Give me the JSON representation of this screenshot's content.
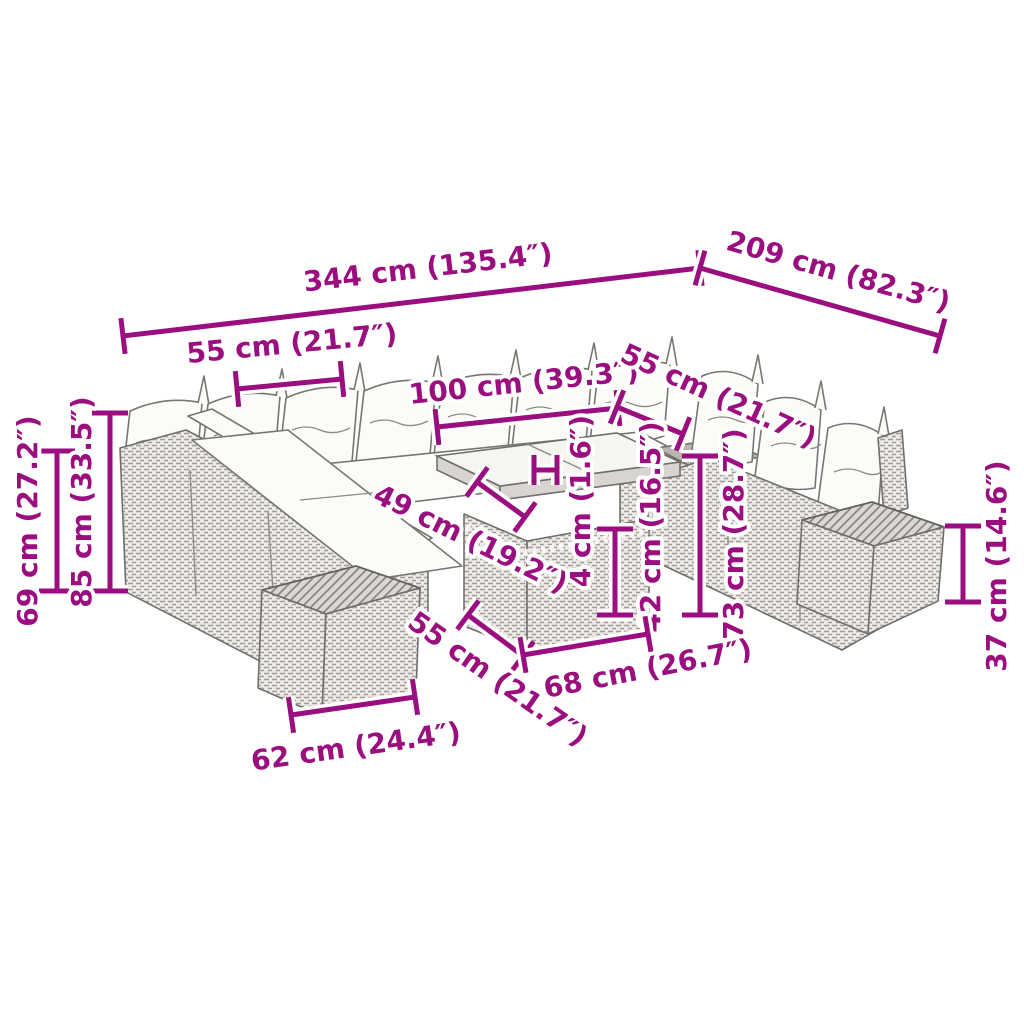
{
  "diagram_title": "garden-lounge-set-dimension-diagram",
  "colors": {
    "dimension_accent": "#9A0E7F",
    "outline": "#6F6F6F",
    "cushion": "#FBFBF8",
    "rattan_base": "#ECEAE6",
    "rattan_weave": "#A29D96",
    "background": "#FFFFFF"
  },
  "dimensions": [
    {
      "id": "total-width",
      "label": "344 cm (135.4″)",
      "line": {
        "x1": 123,
        "y1": 336,
        "x2": 700,
        "y2": 268
      },
      "label_pos": {
        "x": 428,
        "y": 269,
        "rotate": -6.7
      }
    },
    {
      "id": "total-depth",
      "label": "209 cm (82.3″)",
      "line": {
        "x1": 700,
        "y1": 268,
        "x2": 940,
        "y2": 336
      },
      "label_pos": {
        "x": 838,
        "y": 273,
        "rotate": 15.8
      }
    },
    {
      "id": "seat-width-back",
      "label": "55 cm (21.7″)",
      "line": {
        "x1": 237,
        "y1": 389,
        "x2": 342,
        "y2": 379
      },
      "label_pos": {
        "x": 292,
        "y": 345,
        "rotate": -5.5
      }
    },
    {
      "id": "table-top-length",
      "label": "100 cm (39.3″)",
      "line": {
        "x1": 437,
        "y1": 427,
        "x2": 618,
        "y2": 408
      },
      "label_pos": {
        "x": 524,
        "y": 384,
        "rotate": -6
      }
    },
    {
      "id": "seat-width-right",
      "label": "55 cm (21.7″)",
      "line": {
        "x1": 617,
        "y1": 407,
        "x2": 683,
        "y2": 434
      },
      "label_pos": {
        "x": 718,
        "y": 397,
        "rotate": 24.5
      }
    },
    {
      "id": "seat-height",
      "label": "69 cm (27.2″)",
      "line": {
        "x1": 57,
        "y1": 451,
        "x2": 57,
        "y2": 591
      },
      "label_pos": {
        "x": 29,
        "y": 521,
        "rotate": -90
      }
    },
    {
      "id": "back-height",
      "label": "85 cm (33.5″)",
      "line": {
        "x1": 110,
        "y1": 413,
        "x2": 110,
        "y2": 591
      },
      "label_pos": {
        "x": 83,
        "y": 502,
        "rotate": -90
      }
    },
    {
      "id": "table-glass-depth",
      "label": "49 cm (19.2″)",
      "line": {
        "x1": 477,
        "y1": 482,
        "x2": 525,
        "y2": 517
      },
      "label_pos": {
        "x": 470,
        "y": 540,
        "rotate": 26
      }
    },
    {
      "id": "table-top-thickness-marker",
      "label": "",
      "line": {
        "x1": 534,
        "y1": 470,
        "x2": 557,
        "y2": 470
      },
      "tick": 15
    },
    {
      "id": "table-top-thickness",
      "label": "4 cm (1.6″)",
      "label_pos": {
        "x": 582,
        "y": 501,
        "rotate": -90
      }
    },
    {
      "id": "table-base-height",
      "label": "42 cm (16.5″)",
      "line": {
        "x1": 615,
        "y1": 529,
        "x2": 615,
        "y2": 615
      },
      "label_pos": {
        "x": 652,
        "y": 527,
        "rotate": -90
      }
    },
    {
      "id": "sofa-table-height",
      "label": "73 cm (28.7″)",
      "line": {
        "x1": 700,
        "y1": 456,
        "x2": 700,
        "y2": 615
      },
      "label_pos": {
        "x": 735,
        "y": 534,
        "rotate": -90
      }
    },
    {
      "id": "stool-height",
      "label": "37 cm (14.6″)",
      "line": {
        "x1": 963,
        "y1": 526,
        "x2": 963,
        "y2": 602
      },
      "label_pos": {
        "x": 998,
        "y": 566,
        "rotate": -90
      }
    },
    {
      "id": "table-base-width",
      "label": "55 cm (21.7″)",
      "line": {
        "x1": 468,
        "y1": 615,
        "x2": 523,
        "y2": 656
      },
      "label_pos": {
        "x": 497,
        "y": 680,
        "rotate": 35
      }
    },
    {
      "id": "table-base-length",
      "label": "68 cm (26.7″)",
      "line": {
        "x1": 523,
        "y1": 655,
        "x2": 648,
        "y2": 634
      },
      "label_pos": {
        "x": 648,
        "y": 670,
        "rotate": -11
      }
    },
    {
      "id": "stool-width",
      "label": "62 cm (24.4″)",
      "line": {
        "x1": 291,
        "y1": 715,
        "x2": 415,
        "y2": 697
      },
      "label_pos": {
        "x": 356,
        "y": 748,
        "rotate": -8
      }
    }
  ]
}
